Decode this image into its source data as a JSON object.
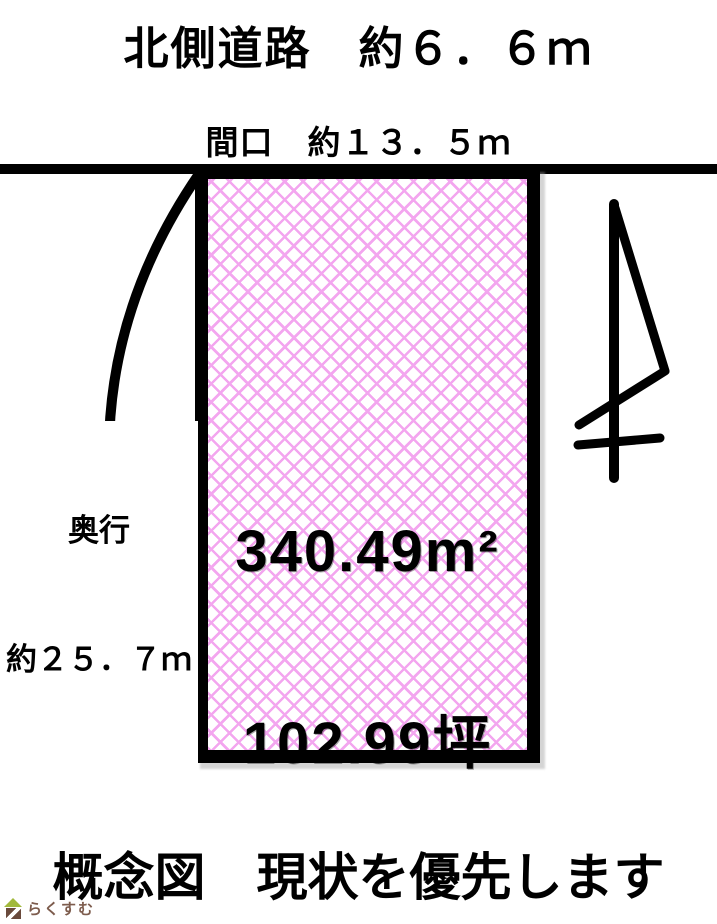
{
  "diagram": {
    "title": "北側道路　約６．６ｍ",
    "frontage_label": "間口　約１３．５ｍ",
    "depth_label_line1": "奥行",
    "depth_label_line2": "約２５．７ｍ",
    "area_m2": "340.49m²",
    "area_tsubo": "102.99坪",
    "caption": "概念図　現状を優先します",
    "colors": {
      "hatch": "#f3a6ef",
      "outline": "#000000",
      "road": "#000000"
    },
    "icons": {
      "north_arrow": "north-arrow-icon",
      "depth_arc": "depth-arc",
      "house": "house-icon"
    }
  },
  "branding": {
    "logo_text": "らくすむ",
    "roof_color": "#a2b93d",
    "body_color": "#6a4a3c",
    "text_color": "#7d5c4d"
  }
}
